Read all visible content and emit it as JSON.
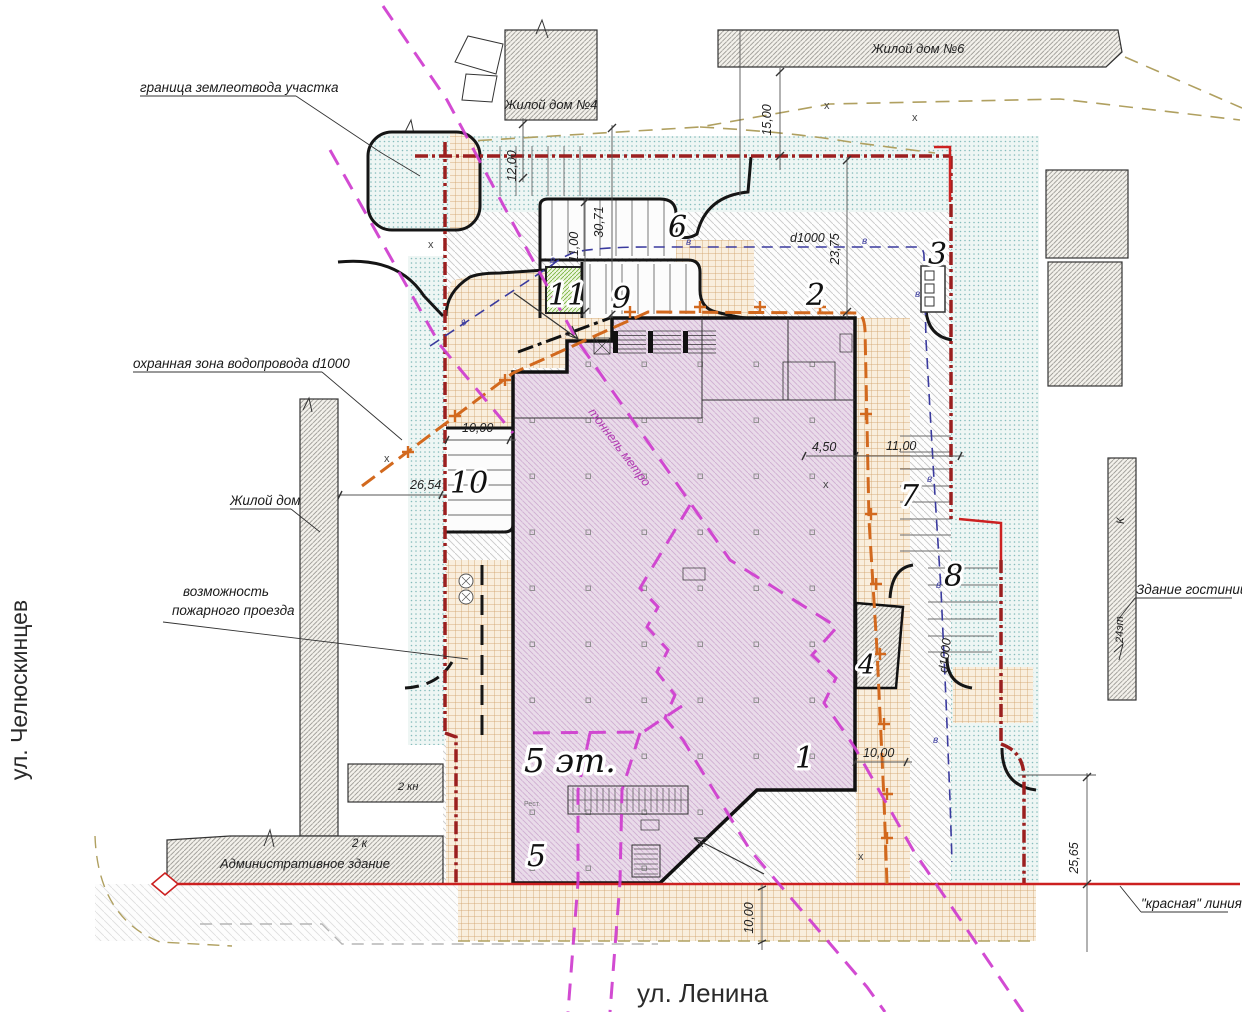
{
  "plan": {
    "streets": {
      "left": "ул. Челюскинцев",
      "bottom": "ул. Ленина"
    },
    "buildings": {
      "house4": "Жилой дом №4",
      "house6": "Жилой дом №6",
      "admin": "Административное здание",
      "admin_storeys": "2 к",
      "annex_storeys": "2 кн",
      "hotel_name": "Здание гостиницы",
      "hotel_material": "К",
      "hotel_storeys": "24эт",
      "main_storeys": "5 эт.",
      "tiny_room": "Рест."
    },
    "annotations": {
      "land_boundary": "граница землеотвода участка",
      "water_protect_zone": "охранная зона водопровода d1000",
      "residential": "Жилой дом",
      "fire_line1": "возможность",
      "fire_line2": "пожарного проезда",
      "red_line": "\"красная\" линия",
      "metro_tunnel": "тоннель метро"
    },
    "zones": {
      "z1": "1",
      "z2": "2",
      "z3": "3",
      "z4": "4",
      "z5": "5",
      "z6": "6",
      "z7": "7",
      "z8": "8",
      "z9": "9",
      "z10": "10",
      "z11": "11"
    },
    "dims": {
      "v12": "12,00",
      "v15": "15,00",
      "v3071": "30,71",
      "v11": "11,00",
      "v2375": "23,75",
      "h_d1000": "d1000",
      "v_d1000": "d1000",
      "h10_left": "10,00",
      "h2654": "26,54",
      "h450": "4,50",
      "h11_right": "11,00",
      "h10_right": "10,00",
      "v10_bottom": "10,00",
      "v2565": "25,65"
    },
    "marks": {
      "water": "в",
      "cross": "х"
    }
  },
  "colors": {
    "boundary_dark_red": "#9b1f1f",
    "red_line": "#cc2020",
    "water_blue": "#3a3a9e",
    "heat_orange": "#d2691e",
    "metro_magenta": "#cf3ccf",
    "survey_tan": "#b0a060",
    "building_pink": "#e9dbe9",
    "greenery_teal": "#8fc4c4",
    "paving_tan": "#cf9f63",
    "lawn_green": "#79b340"
  }
}
